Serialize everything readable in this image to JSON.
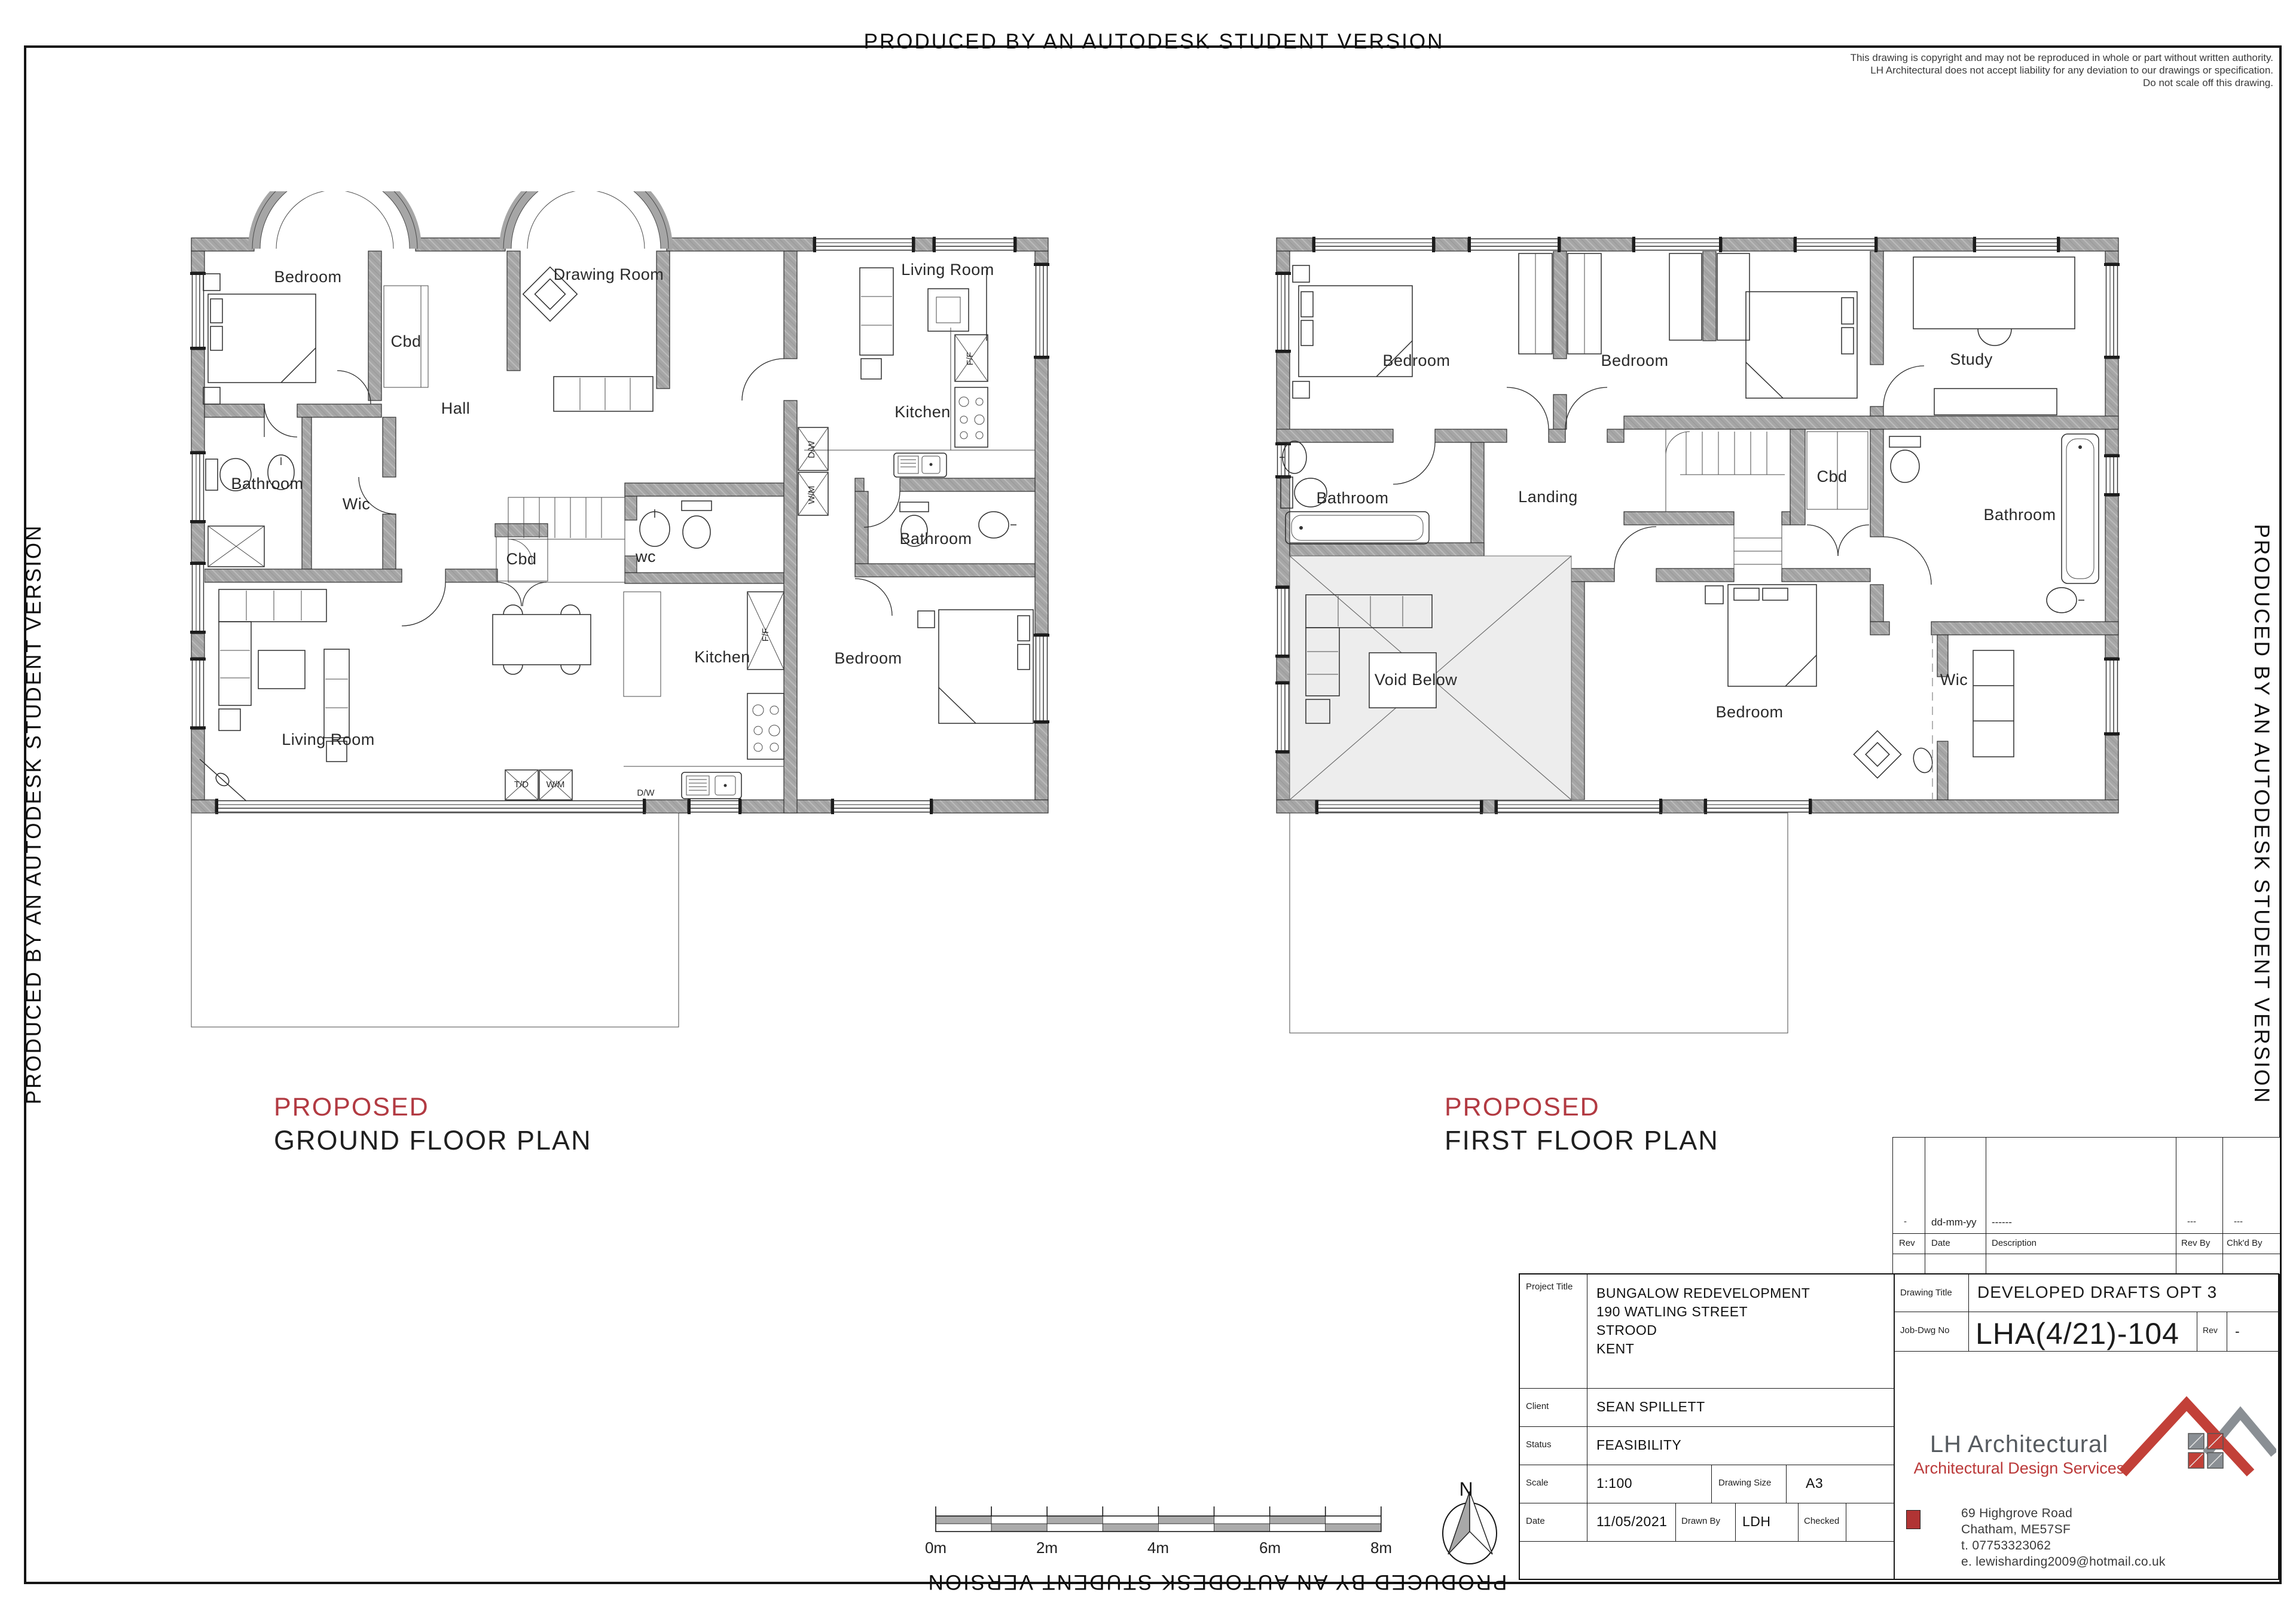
{
  "banner": {
    "text": "PRODUCED BY AN AUTODESK STUDENT VERSION"
  },
  "disclaimer": {
    "line1": "This drawing is copyright and may not be reproduced in whole or part without written authority.",
    "line2": "LH Architectural does not accept liability for any deviation to our drawings or specification.",
    "line3": "Do not scale off this drawing."
  },
  "ground_plan": {
    "tag": "PROPOSED",
    "title": "GROUND FLOOR PLAN",
    "rooms": {
      "bedroom": "Bedroom",
      "cbd1": "Cbd",
      "drawing_room": "Drawing Room",
      "hall": "Hall",
      "bathroom": "Bathroom",
      "wic": "Wic",
      "cbd2": "Cbd",
      "wc": "wc",
      "kitchen": "Kitchen",
      "living_room": "Living Room",
      "annexe_living": "Living Room",
      "annexe_kitchen": "Kitchen",
      "annexe_bathroom": "Bathroom",
      "annexe_bedroom": "Bedroom"
    },
    "appliances": {
      "ff": "F/F",
      "dw": "D/W",
      "td": "T/D",
      "wm": "W/M",
      "annexe_ff": "F/F",
      "annexe_dw": "D/W",
      "annexe_wm": "W/M"
    }
  },
  "first_plan": {
    "tag": "PROPOSED",
    "title": "FIRST FLOOR PLAN",
    "rooms": {
      "bedroom1": "Bedroom",
      "bedroom2": "Bedroom",
      "study": "Study",
      "bathroom_left": "Bathroom",
      "landing": "Landing",
      "cbd": "Cbd",
      "bathroom_right": "Bathroom",
      "void_below": "Void Below",
      "bedroom3": "Bedroom",
      "wic": "Wic"
    }
  },
  "scale_bar": {
    "labels": [
      "0m",
      "2m",
      "4m",
      "6m",
      "8m"
    ]
  },
  "north": {
    "label": "N"
  },
  "revision_table": {
    "headers": {
      "rev": "Rev",
      "date": "Date",
      "description": "Description",
      "rev_by": "Rev By",
      "chkd_by": "Chk'd By"
    },
    "entry": {
      "rev": "-",
      "date": "dd-mm-yy",
      "description": "------",
      "rev_by": "---",
      "chkd_by": "---"
    }
  },
  "title_block": {
    "project_title_label": "Project Title",
    "project_title_lines": [
      "BUNGALOW REDEVELOPMENT",
      "190 WATLING STREET",
      "STROOD",
      "KENT"
    ],
    "client_label": "Client",
    "client": "SEAN SPILLETT",
    "status_label": "Status",
    "status": "FEASIBILITY",
    "scale_label": "Scale",
    "scale": "1:100",
    "drawing_size_label": "Drawing Size",
    "drawing_size": "A3",
    "date_label": "Date",
    "date": "11/05/2021",
    "drawn_by_label": "Drawn By",
    "drawn_by": "LDH",
    "checked_label": "Checked",
    "checked": "",
    "drawing_title_label": "Drawing Title",
    "drawing_title": "DEVELOPED DRAFTS OPT 3",
    "job_dwg_no_label": "Job-Dwg No",
    "job_dwg_no": "LHA(4/21)-104",
    "rev_label": "Rev",
    "rev": "-",
    "company": {
      "name": "LH Architectural",
      "tagline": "Architectural Design Services",
      "address": [
        "69 Highgrove Road",
        "Chatham, ME57SF",
        "t.  07753323062",
        "e. lewisharding2009@hotmail.co.uk"
      ]
    }
  },
  "colors": {
    "accent_red": "#b23a42",
    "logo_red": "#bb3a3a",
    "logo_gray": "#8a8f94",
    "wall_gray": "#a6a6a6",
    "void_gray": "#ededed"
  }
}
